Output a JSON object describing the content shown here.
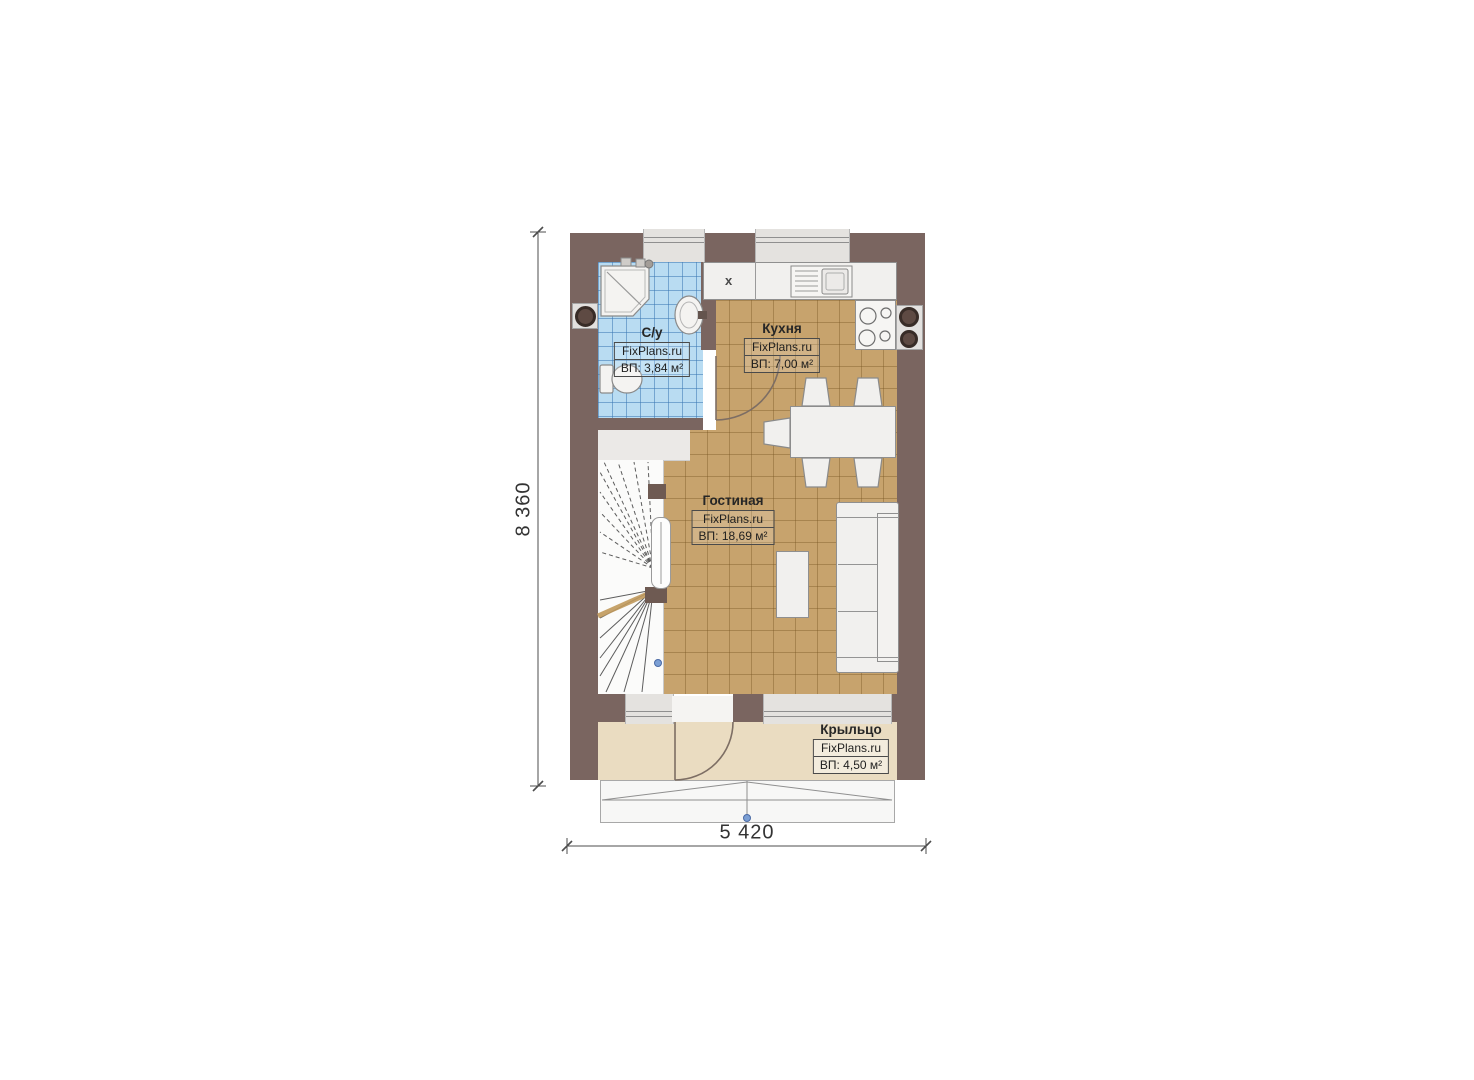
{
  "rooms": {
    "bathroom": {
      "name": "С/у",
      "brand": "FixPlans.ru",
      "area": "ВП: 3,84 м²"
    },
    "kitchen": {
      "name": "Кухня",
      "brand": "FixPlans.ru",
      "area": "ВП: 7,00 м²"
    },
    "living": {
      "name": "Гостиная",
      "brand": "FixPlans.ru",
      "area": "ВП: 18,69 м²"
    },
    "porch": {
      "name": "Крыльцо",
      "brand": "FixPlans.ru",
      "area": "ВП: 4,50 м²"
    }
  },
  "dimensions": {
    "vertical": "8 360",
    "horizontal": "5 420"
  },
  "marks": {
    "counter_x": "x"
  },
  "colors": {
    "wall": "#7a6560",
    "bath_tile": "#b9dcf2",
    "floor_tile": "#c7a36d",
    "porch_floor": "#eadcc1",
    "furniture": "#f1f0ee",
    "marker_blue": "#7b9fd4"
  }
}
